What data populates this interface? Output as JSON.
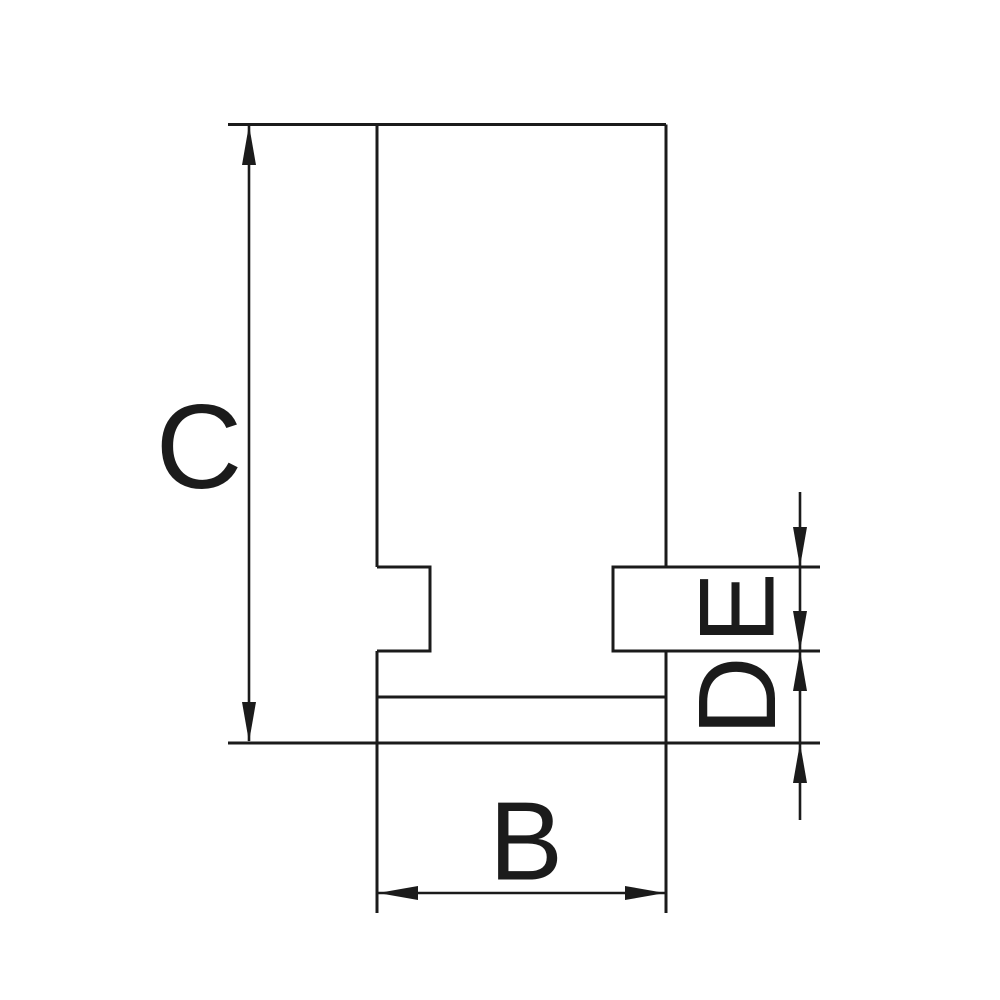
{
  "drawing": {
    "type": "technical-dimension-drawing",
    "subject": "chuck-jaw-side-profile",
    "labels": {
      "c": "C",
      "b": "B",
      "d": "D",
      "e": "E"
    },
    "dimensions": [
      {
        "label": "C",
        "orientation": "vertical",
        "measures": "overall height, left side"
      },
      {
        "label": "B",
        "orientation": "horizontal",
        "measures": "overall width, bottom"
      },
      {
        "label": "E",
        "orientation": "vertical",
        "measures": "tongue height, right side upper"
      },
      {
        "label": "D",
        "orientation": "vertical",
        "measures": "step height, right side lower"
      }
    ],
    "colors": {
      "line": "#1b1b1b",
      "background": "#ffffff"
    }
  }
}
